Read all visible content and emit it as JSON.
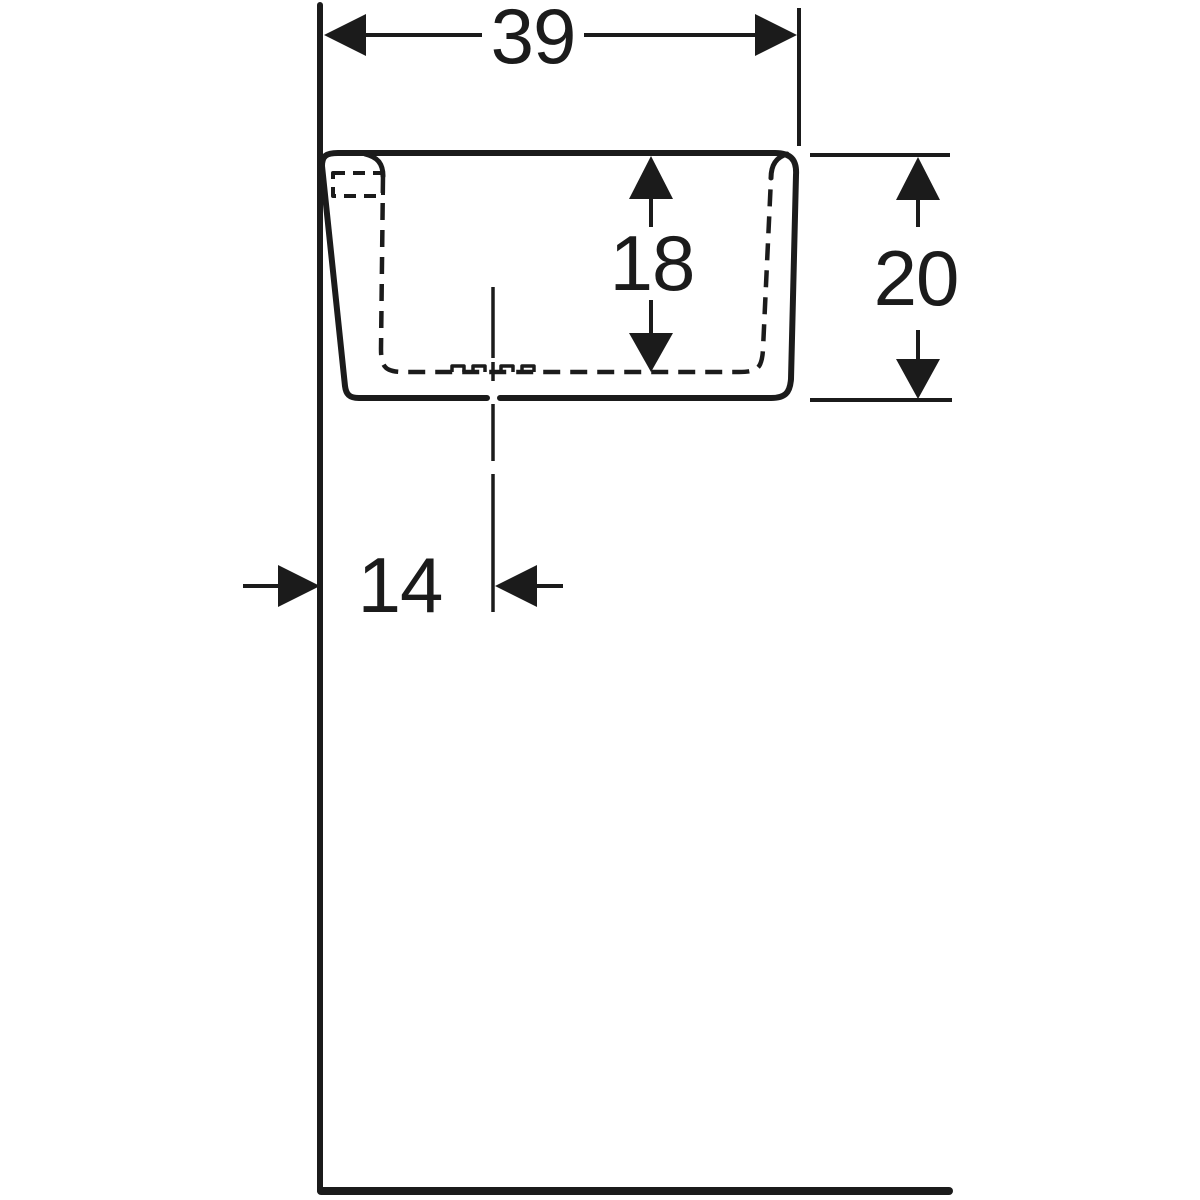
{
  "style": {
    "ink": "#1b1b1b",
    "background": "#ffffff"
  },
  "drawing": {
    "dimensions": {
      "top_width": "39",
      "bowl_depth": "18",
      "overall_height": "20",
      "centerline_offset": "14"
    }
  }
}
